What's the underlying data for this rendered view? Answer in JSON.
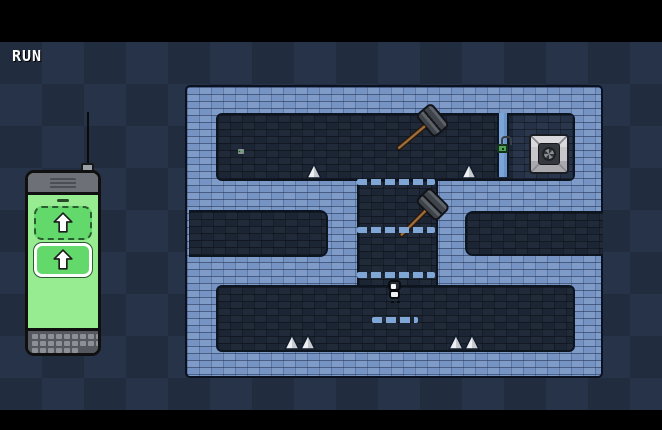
{
  "hud": {
    "run_label": "RUN"
  },
  "remote": {
    "buttons": [
      {
        "id": "command-button-1",
        "icon": "arrow-up",
        "style": "dashed"
      },
      {
        "id": "command-button-2",
        "icon": "arrow-up",
        "style": "selected"
      }
    ],
    "key_rows": [
      9,
      9,
      6
    ]
  },
  "level": {
    "rooms": [
      "top-room",
      "locked-chamber",
      "vertical-corridor",
      "left-passage",
      "right-passage",
      "bottom-room"
    ],
    "objects": [
      {
        "type": "key",
        "name": "key",
        "x": 238,
        "y": 107
      },
      {
        "type": "spike",
        "name": "spike",
        "x": 306,
        "y": 121
      },
      {
        "type": "spike",
        "name": "spike",
        "x": 461,
        "y": 121
      },
      {
        "type": "hammer",
        "name": "hammer",
        "x": 400,
        "y": 66,
        "rot": 50
      },
      {
        "type": "door",
        "name": "door",
        "x": 497,
        "y": 71
      },
      {
        "type": "lock",
        "name": "padlock",
        "x": 497,
        "y": 97
      },
      {
        "type": "goal-button",
        "name": "goal-button",
        "x": 529,
        "y": 92
      },
      {
        "type": "platform-row",
        "name": "platform-row",
        "x": 357,
        "y": 137,
        "w": 78
      },
      {
        "type": "hammer",
        "name": "hammer",
        "x": 400,
        "y": 150,
        "rot": 45
      },
      {
        "type": "platform-row",
        "name": "platform-row",
        "x": 357,
        "y": 185,
        "w": 78
      },
      {
        "type": "platform-row",
        "name": "platform-row",
        "x": 357,
        "y": 230,
        "w": 78
      },
      {
        "type": "character",
        "name": "player-character",
        "x": 387,
        "y": 238
      },
      {
        "type": "platform-row",
        "name": "platform-row",
        "x": 372,
        "y": 275,
        "w": 46
      },
      {
        "type": "spike",
        "name": "spike",
        "x": 284,
        "y": 292
      },
      {
        "type": "spike",
        "name": "spike",
        "x": 300,
        "y": 292
      },
      {
        "type": "spike",
        "name": "spike",
        "x": 448,
        "y": 292
      },
      {
        "type": "spike",
        "name": "spike",
        "x": 464,
        "y": 292
      }
    ]
  },
  "colors": {
    "wall_brick": "#7593c3",
    "room_dark": "#1b2534",
    "platform": "#7fa6d4",
    "door_blue": "#7ba4d8",
    "lock_green": "#53a257",
    "key_green": "#5dbb63",
    "screen_green": "#97ec92",
    "button_green": "#62d96a",
    "background_dark": "#212c3f",
    "background_light": "#273349"
  }
}
